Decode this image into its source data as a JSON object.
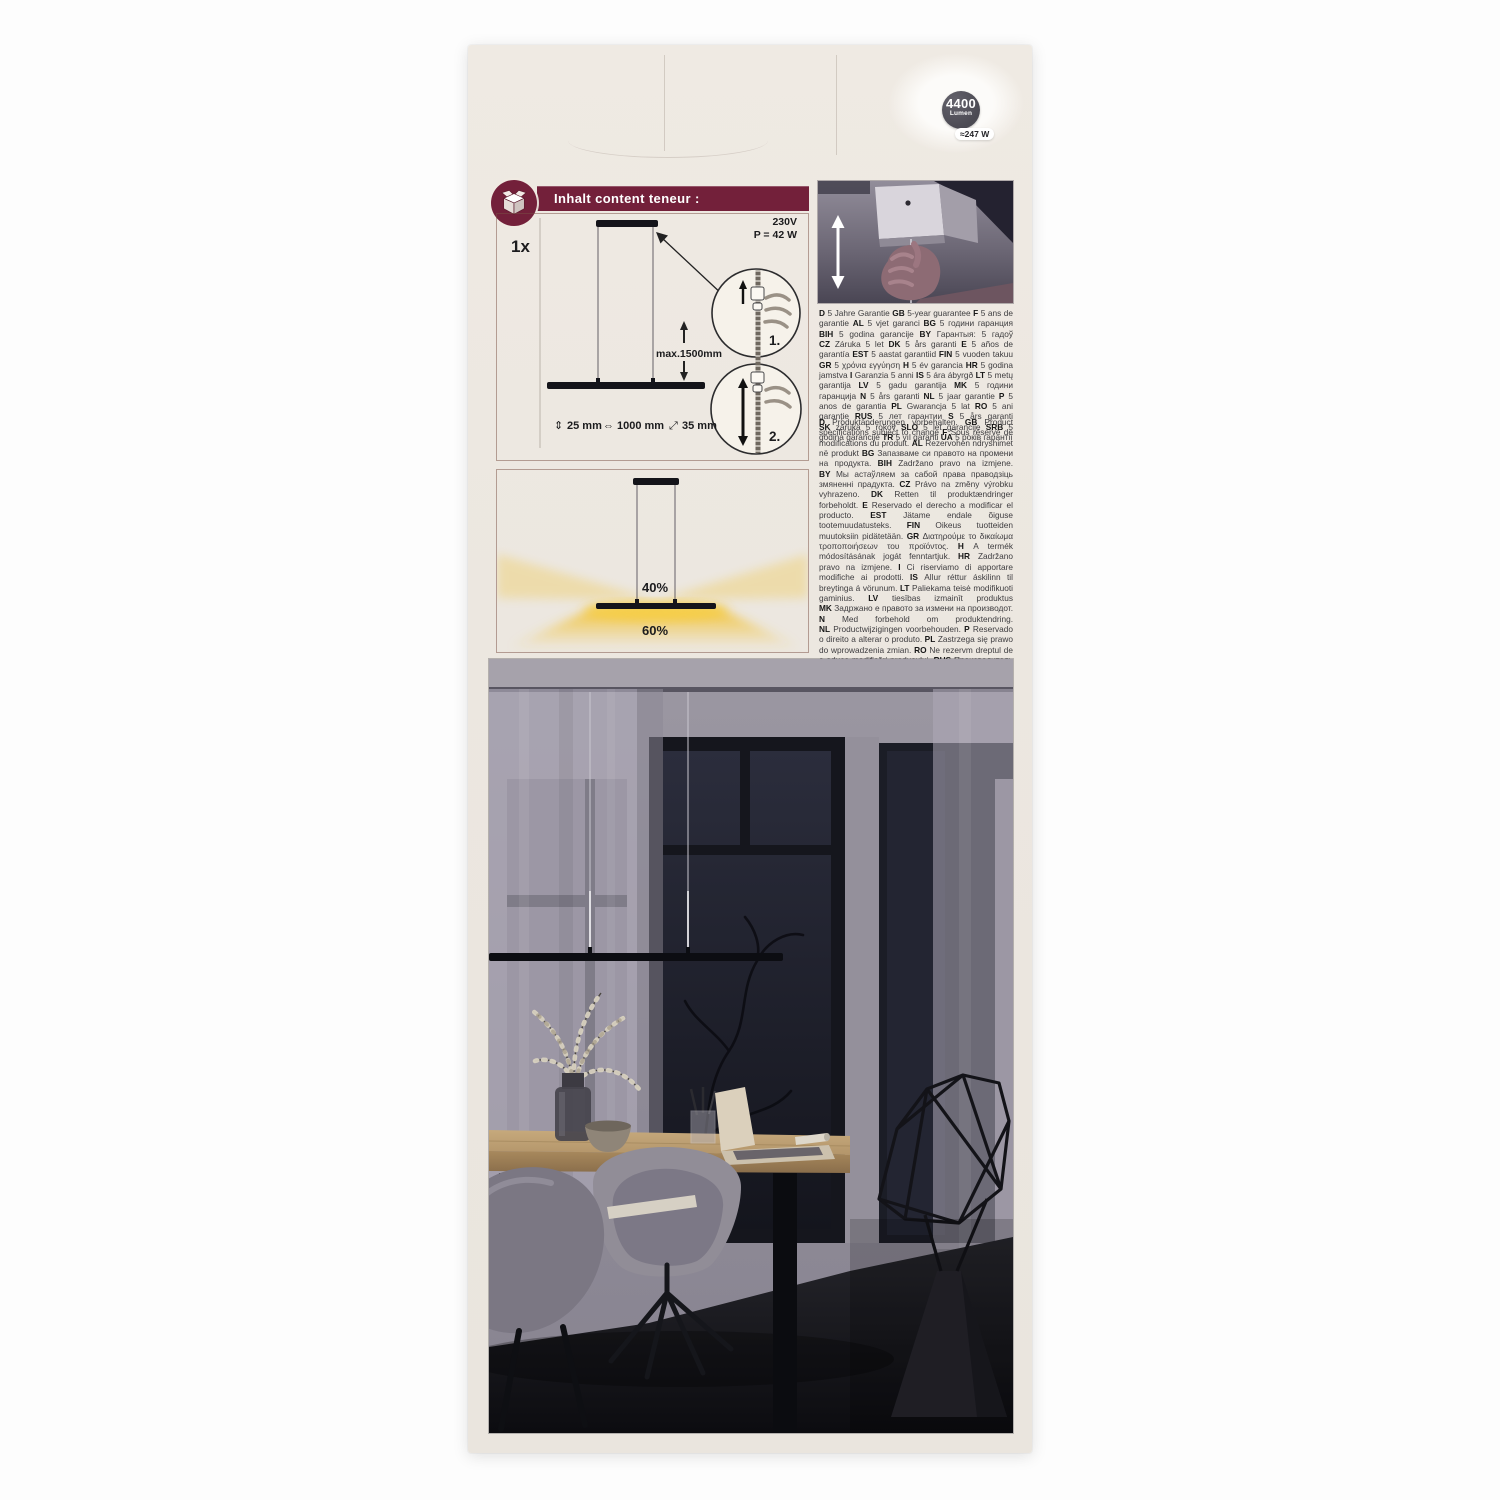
{
  "badge": {
    "lumen_value": "4400",
    "lumen_unit": "Lumen",
    "wattage": "≈247 W"
  },
  "header": {
    "title": "Inhalt content teneur :"
  },
  "spec_diagram": {
    "quantity": "1x",
    "voltage": "230V",
    "power": "P = 42 W",
    "max_drop": "max.1500mm",
    "dims": {
      "height_symbol": "⇕",
      "height": "25 mm",
      "width_symbol": "⇔",
      "width": "1000 mm",
      "depth_symbol": "⤢",
      "depth": "35 mm"
    },
    "step_1": "1.",
    "step_2": "2."
  },
  "light_distribution": {
    "upward": "40%",
    "downward": "60%"
  },
  "guarantee": {
    "segments": [
      [
        "D",
        "5 Jahre Garantie"
      ],
      [
        "GB",
        "5-year guarantee"
      ],
      [
        "F",
        "5 ans de garantie"
      ],
      [
        "AL",
        "5 vjet garanci"
      ],
      [
        "BG",
        "5 години гаранция"
      ],
      [
        "BIH",
        "5 godina garancije"
      ],
      [
        "BY",
        "Гарантыя: 5 гадоў"
      ],
      [
        "CZ",
        "Záruka 5 let"
      ],
      [
        "DK",
        "5 års garanti"
      ],
      [
        "E",
        "5 años de garantía"
      ],
      [
        "EST",
        "5 aastat garantiid"
      ],
      [
        "FIN",
        "5 vuoden takuu"
      ],
      [
        "GR",
        "5 χρόνια εγγύηση"
      ],
      [
        "H",
        "5 év garancia"
      ],
      [
        "HR",
        "5 godina jamstva"
      ],
      [
        "I",
        "Garanzia 5 anni"
      ],
      [
        "IS",
        "5 ára ábyrgð"
      ],
      [
        "LT",
        "5 metų garantija"
      ],
      [
        "LV",
        "5 gadu garantija"
      ],
      [
        "MK",
        "5 години гаранција"
      ],
      [
        "N",
        "5 års garanti"
      ],
      [
        "NL",
        "5 jaar garantie"
      ],
      [
        "P",
        "5 anos de garantia"
      ],
      [
        "PL",
        "Gwarancja 5 lat"
      ],
      [
        "RO",
        "5 ani garanție"
      ],
      [
        "RUS",
        "5 лет гарантии"
      ],
      [
        "S",
        "5 års garanti"
      ],
      [
        "SK",
        "záruka 5 rokov"
      ],
      [
        "SLO",
        "5 let garancije"
      ],
      [
        "SRB",
        "5 godina garancije"
      ],
      [
        "TR",
        "5 yıl garanti"
      ],
      [
        "UA",
        "5 років гарантії"
      ]
    ]
  },
  "modifications": {
    "segments": [
      [
        "D",
        "Produktänderungen vorbehalten."
      ],
      [
        "GB",
        "Product specifications subject to change"
      ],
      [
        "F",
        "Sous réserve de modifications du produit."
      ],
      [
        "AL",
        "Rezervohen ndryshimet në produkt"
      ],
      [
        "BG",
        "Запазваме си правото на промени на продукта."
      ],
      [
        "BIH",
        "Zadržano pravo na izmjene."
      ],
      [
        "BY",
        "Мы астаўляем за сабой права праводзіць змяненні прадукта."
      ],
      [
        "CZ",
        "Právo na změny výrobku vyhrazeno."
      ],
      [
        "DK",
        "Retten til produktændringer forbeholdt."
      ],
      [
        "E",
        "Reservado el derecho a modificar el producto."
      ],
      [
        "EST",
        "Jätame endale õiguse tootemuudatusteks."
      ],
      [
        "FIN",
        "Oikeus tuotteiden muutoksiin pidätetään."
      ],
      [
        "GR",
        "Διατηρούμε το δικαίωμα τροποποιήσεων του προϊόντος."
      ],
      [
        "H",
        "A termék módosításának jogát fenntartjuk."
      ],
      [
        "HR",
        "Zadržano pravo na izmjene."
      ],
      [
        "I",
        "Ci riserviamo di apportare modifiche ai prodotti."
      ],
      [
        "IS",
        "Allur réttur áskilinn til breytinga á vörunum."
      ],
      [
        "LT",
        "Paliekama teisė modifikuoti gaminius."
      ],
      [
        "LV",
        "tiesības izmainīt produktus"
      ],
      [
        "MK",
        "Задржано е правото за измени на производот."
      ],
      [
        "N",
        "Med forbehold om produktendring."
      ],
      [
        "NL",
        "Productwijzigingen voorbehouden."
      ],
      [
        "P",
        "Reservado o direito a alterar o produto."
      ],
      [
        "PL",
        "Zastrzega się prawo do wprowadzenia zmian."
      ],
      [
        "RO",
        "Ne rezervm dreptul de a aduce modificări produsului."
      ],
      [
        "RUS",
        "Производитель сохраняет за собой право на модификацию изделия."
      ],
      [
        "S",
        "Vi förbehåller oss rätten till produktändringar."
      ],
      [
        "SK",
        "Zmeny výrobkov vyhradené."
      ],
      [
        "SLO",
        "Pridržujemo si pravico do sprememb proizvoda."
      ],
      [
        "SRB",
        "Zadržano pravo na izmene."
      ],
      [
        "TR",
        "Üründe değişiklik yapma hakkı saklıdır."
      ],
      [
        "UA",
        "Виробник залишає за собою права на здійснення модифікацій продукту."
      ]
    ]
  },
  "colors": {
    "accent_maroon": "#73203a",
    "badge_gray": "#4b4a53",
    "beam_yellow": "#f2c233",
    "cardboard": "#ece7e0"
  }
}
